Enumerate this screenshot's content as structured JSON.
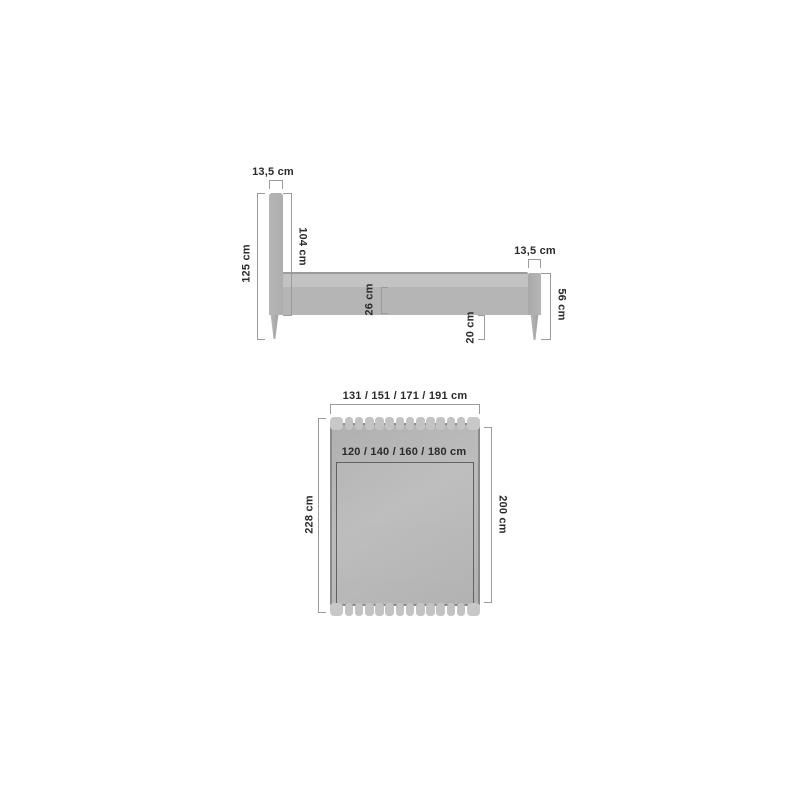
{
  "colors": {
    "page_bg": "#ffffff",
    "text": "#2a2a2a",
    "dim_line": "#9b9b9b",
    "bed_fill": "#b5b5b5",
    "bed_fill_light": "#c3c3c3",
    "bed_edge": "#8a8a8a"
  },
  "side_view": {
    "headboard_width": "13,5 cm",
    "headboard_height": "104 cm",
    "total_height": "125 cm",
    "frame_height": "26 cm",
    "leg_height": "20 cm",
    "footboard_width": "13,5 cm",
    "footboard_height": "56 cm"
  },
  "top_view": {
    "frame_widths": "131 / 151 / 171 / 191 cm",
    "mattress_widths": "120 / 140 / 160 / 180 cm",
    "frame_length": "228 cm",
    "mattress_length": "200 cm"
  }
}
